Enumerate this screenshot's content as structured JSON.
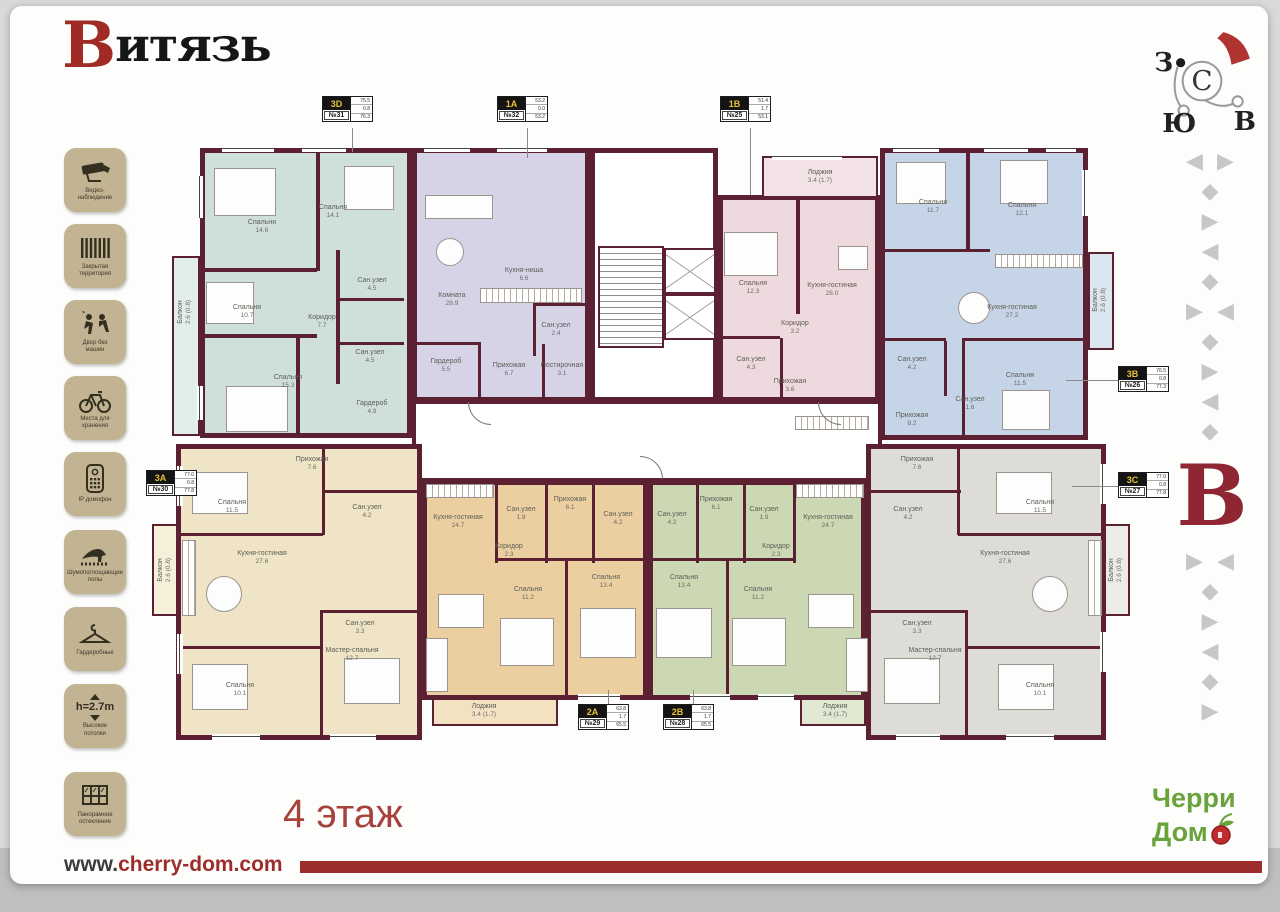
{
  "header": {
    "logo": "Витязь"
  },
  "compass": {
    "n": "С",
    "s": "Ю",
    "w": "З",
    "e": "В"
  },
  "sidebar": [
    {
      "l1": "Видео-",
      "l2": "наблюдение"
    },
    {
      "l1": "Закрытая",
      "l2": "территория"
    },
    {
      "l1": "Двор без",
      "l2": "машин"
    },
    {
      "l1": "Места для",
      "l2": "хранения"
    },
    {
      "l1": "IP домофон",
      "l2": ""
    },
    {
      "l1": "Шумопоглощающие",
      "l2": "полы"
    },
    {
      "l1": "Гардеробные",
      "l2": ""
    },
    {
      "l1": "Высокие",
      "l2": "потолки",
      "value": "h=2.7m"
    },
    {
      "l1": "Панорамное",
      "l2": "остекление"
    }
  ],
  "floor": {
    "label": "4 этаж"
  },
  "footer": {
    "www": "www.",
    "domain": "cherry-dom.com"
  },
  "brand": {
    "l1": "Черри",
    "l2": "Дом"
  },
  "decor": {
    "initial": "В",
    "rows": [
      "◀ ▶",
      "◆",
      "▶",
      "◀",
      "◆",
      "▶ ◀",
      "◆",
      "▶",
      "◀",
      "◆",
      "▶ ◀",
      "◆",
      "▶",
      "◀",
      "◆",
      "▶"
    ]
  },
  "apartments": [
    {
      "type": "3D",
      "num": "№31",
      "areas": [
        "75.5",
        "0.8",
        "76.3"
      ],
      "rooms": [
        {
          "name": "Спальня",
          "area": "14.6"
        },
        {
          "name": "Спальня",
          "area": "14.1"
        },
        {
          "name": "Спальня",
          "area": "10.7"
        },
        {
          "name": "Коридор",
          "area": "7.7"
        },
        {
          "name": "Сан.узел",
          "area": "4.5"
        },
        {
          "name": "Сан.узел",
          "area": "4.5"
        },
        {
          "name": "Спальня",
          "area": "15.3"
        },
        {
          "name": "Гардероб",
          "area": "4.9"
        },
        {
          "name": "Балкон",
          "area": "2.6 (0.8)"
        }
      ]
    },
    {
      "type": "1A",
      "num": "№32",
      "areas": [
        "53.2",
        "0.0",
        "53.2"
      ],
      "rooms": [
        {
          "name": "Комната",
          "area": "28.9"
        },
        {
          "name": "Кухня-ниша",
          "area": "6.6"
        },
        {
          "name": "Сан.узел",
          "area": "2.4"
        },
        {
          "name": "Гардероб",
          "area": "5.5"
        },
        {
          "name": "Прихожая",
          "area": "6.7"
        },
        {
          "name": "Постирочная",
          "area": "3.1"
        }
      ]
    },
    {
      "type": "1B",
      "num": "№25",
      "areas": [
        "51.4",
        "1.7",
        "53.1"
      ],
      "rooms": [
        {
          "name": "Лоджия",
          "area": "3.4 (1.7)"
        },
        {
          "name": "Спальня",
          "area": "12.3"
        },
        {
          "name": "Кухня-гостиная",
          "area": "28.0"
        },
        {
          "name": "Коридор",
          "area": "3.2"
        },
        {
          "name": "Сан.узел",
          "area": "4.3"
        },
        {
          "name": "Прихожая",
          "area": "3.6"
        }
      ]
    },
    {
      "type": "3B",
      "num": "№26",
      "areas": [
        "76.5",
        "0.8",
        "77.3"
      ],
      "rooms": [
        {
          "name": "Спальня",
          "area": "11.7"
        },
        {
          "name": "Спальня",
          "area": "12.1"
        },
        {
          "name": "Кухня-гостиная",
          "area": "27.2"
        },
        {
          "name": "Спальня",
          "area": "11.5"
        },
        {
          "name": "Сан.узел",
          "area": "4.2"
        },
        {
          "name": "Сан.узел",
          "area": "1.6"
        },
        {
          "name": "Прихожая",
          "area": "8.2"
        },
        {
          "name": "Балкон",
          "area": "2.6 (0.8)"
        }
      ]
    },
    {
      "type": "3A",
      "num": "№30",
      "areas": [
        "77.0",
        "0.8",
        "77.8"
      ],
      "rooms": [
        {
          "name": "Прихожая",
          "area": "7.6"
        },
        {
          "name": "Спальня",
          "area": "11.5"
        },
        {
          "name": "Сан.узел",
          "area": "4.2"
        },
        {
          "name": "Кухня-гостиная",
          "area": "27.6"
        },
        {
          "name": "Сан.узел",
          "area": "3.3"
        },
        {
          "name": "Спальня",
          "area": "10.1"
        },
        {
          "name": "Мастер-спальня",
          "area": "12.7"
        },
        {
          "name": "Балкон",
          "area": "2.6 (0.8)"
        }
      ]
    },
    {
      "type": "2A",
      "num": "№29",
      "areas": [
        "63.8",
        "1.7",
        "65.5"
      ],
      "rooms": [
        {
          "name": "Кухня-гостиная",
          "area": "24.7"
        },
        {
          "name": "Сан.узел",
          "area": "1.9"
        },
        {
          "name": "Прихожая",
          "area": "6.1"
        },
        {
          "name": "Сан.узел",
          "area": "4.2"
        },
        {
          "name": "Коридор",
          "area": "2.3"
        },
        {
          "name": "Спальня",
          "area": "11.2"
        },
        {
          "name": "Спальня",
          "area": "13.4"
        },
        {
          "name": "Лоджия",
          "area": "3.4 (1.7)"
        }
      ]
    },
    {
      "type": "2B",
      "num": "№28",
      "areas": [
        "63.8",
        "1.7",
        "65.5"
      ],
      "rooms": [
        {
          "name": "Прихожая",
          "area": "6.1"
        },
        {
          "name": "Сан.узел",
          "area": "1.9"
        },
        {
          "name": "Сан.узел",
          "area": "4.2"
        },
        {
          "name": "Коридор",
          "area": "2.3"
        },
        {
          "name": "Кухня-гостиная",
          "area": "24.7"
        },
        {
          "name": "Спальня",
          "area": "13.4"
        },
        {
          "name": "Спальня",
          "area": "11.2"
        },
        {
          "name": "Лоджия",
          "area": "3.4 (1.7)"
        }
      ]
    },
    {
      "type": "3C",
      "num": "№27",
      "areas": [
        "77.0",
        "0.8",
        "77.8"
      ],
      "rooms": [
        {
          "name": "Прихожая",
          "area": "7.6"
        },
        {
          "name": "Сан.узел",
          "area": "4.2"
        },
        {
          "name": "Спальня",
          "area": "11.5"
        },
        {
          "name": "Кухня-гостиная",
          "area": "27.6"
        },
        {
          "name": "Сан.узел",
          "area": "3.3"
        },
        {
          "name": "Мастер-спальня",
          "area": "12.7"
        },
        {
          "name": "Спальня",
          "area": "10.1"
        },
        {
          "name": "Балкон",
          "area": "2.6 (0.8)"
        }
      ]
    }
  ]
}
